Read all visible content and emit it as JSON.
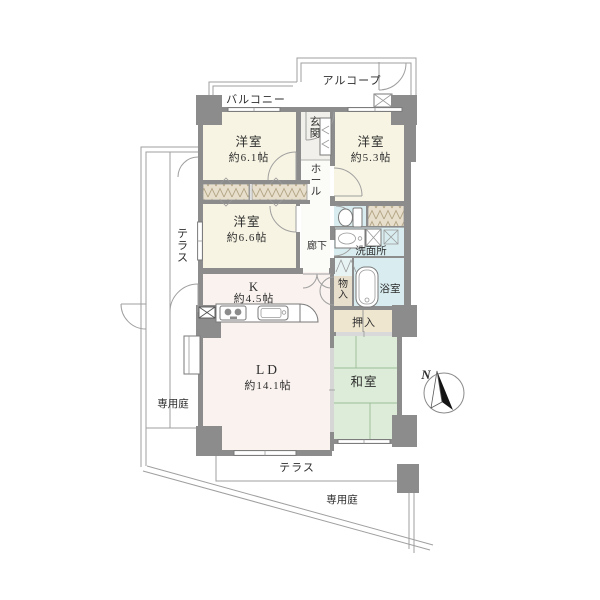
{
  "plan_title": "2SLDK floor plan",
  "colors": {
    "wall": "#8c8c8c",
    "bedroom_fill": "#f7f4e3",
    "living_fill": "#f9f2ef",
    "tatami_fill": "#dcecd8",
    "wet_fill": "#d9edf0",
    "closet_fill": "#e7decb",
    "line": "#9f9f9f"
  },
  "compass": {
    "north_label": "N"
  },
  "outdoor": {
    "balcony": "バルコニー",
    "alcove": "アルコープ",
    "terrace_west": "テラス",
    "terrace_south": "テラス",
    "garden_west": "専用庭",
    "garden_south": "専用庭"
  },
  "rooms": {
    "bedroom_61": {
      "name": "洋室",
      "size": "約6.1帖"
    },
    "bedroom_53": {
      "name": "洋室",
      "size": "約5.3帖"
    },
    "bedroom_66": {
      "name": "洋室",
      "size": "約6.6帖"
    },
    "kitchen": {
      "name": "K",
      "size": "約4.5帖"
    },
    "living_dining": {
      "name": "LD",
      "size": "約14.1帖"
    },
    "japanese_room": {
      "name": "和室"
    },
    "entrance": {
      "name": "玄関"
    },
    "hall": {
      "name": "ホール"
    },
    "corridor": {
      "name": "廊下"
    },
    "washroom": {
      "name": "洗面所"
    },
    "bathroom": {
      "name": "浴室"
    },
    "storage": {
      "name": "物入"
    },
    "closet": {
      "name": "押入"
    }
  }
}
